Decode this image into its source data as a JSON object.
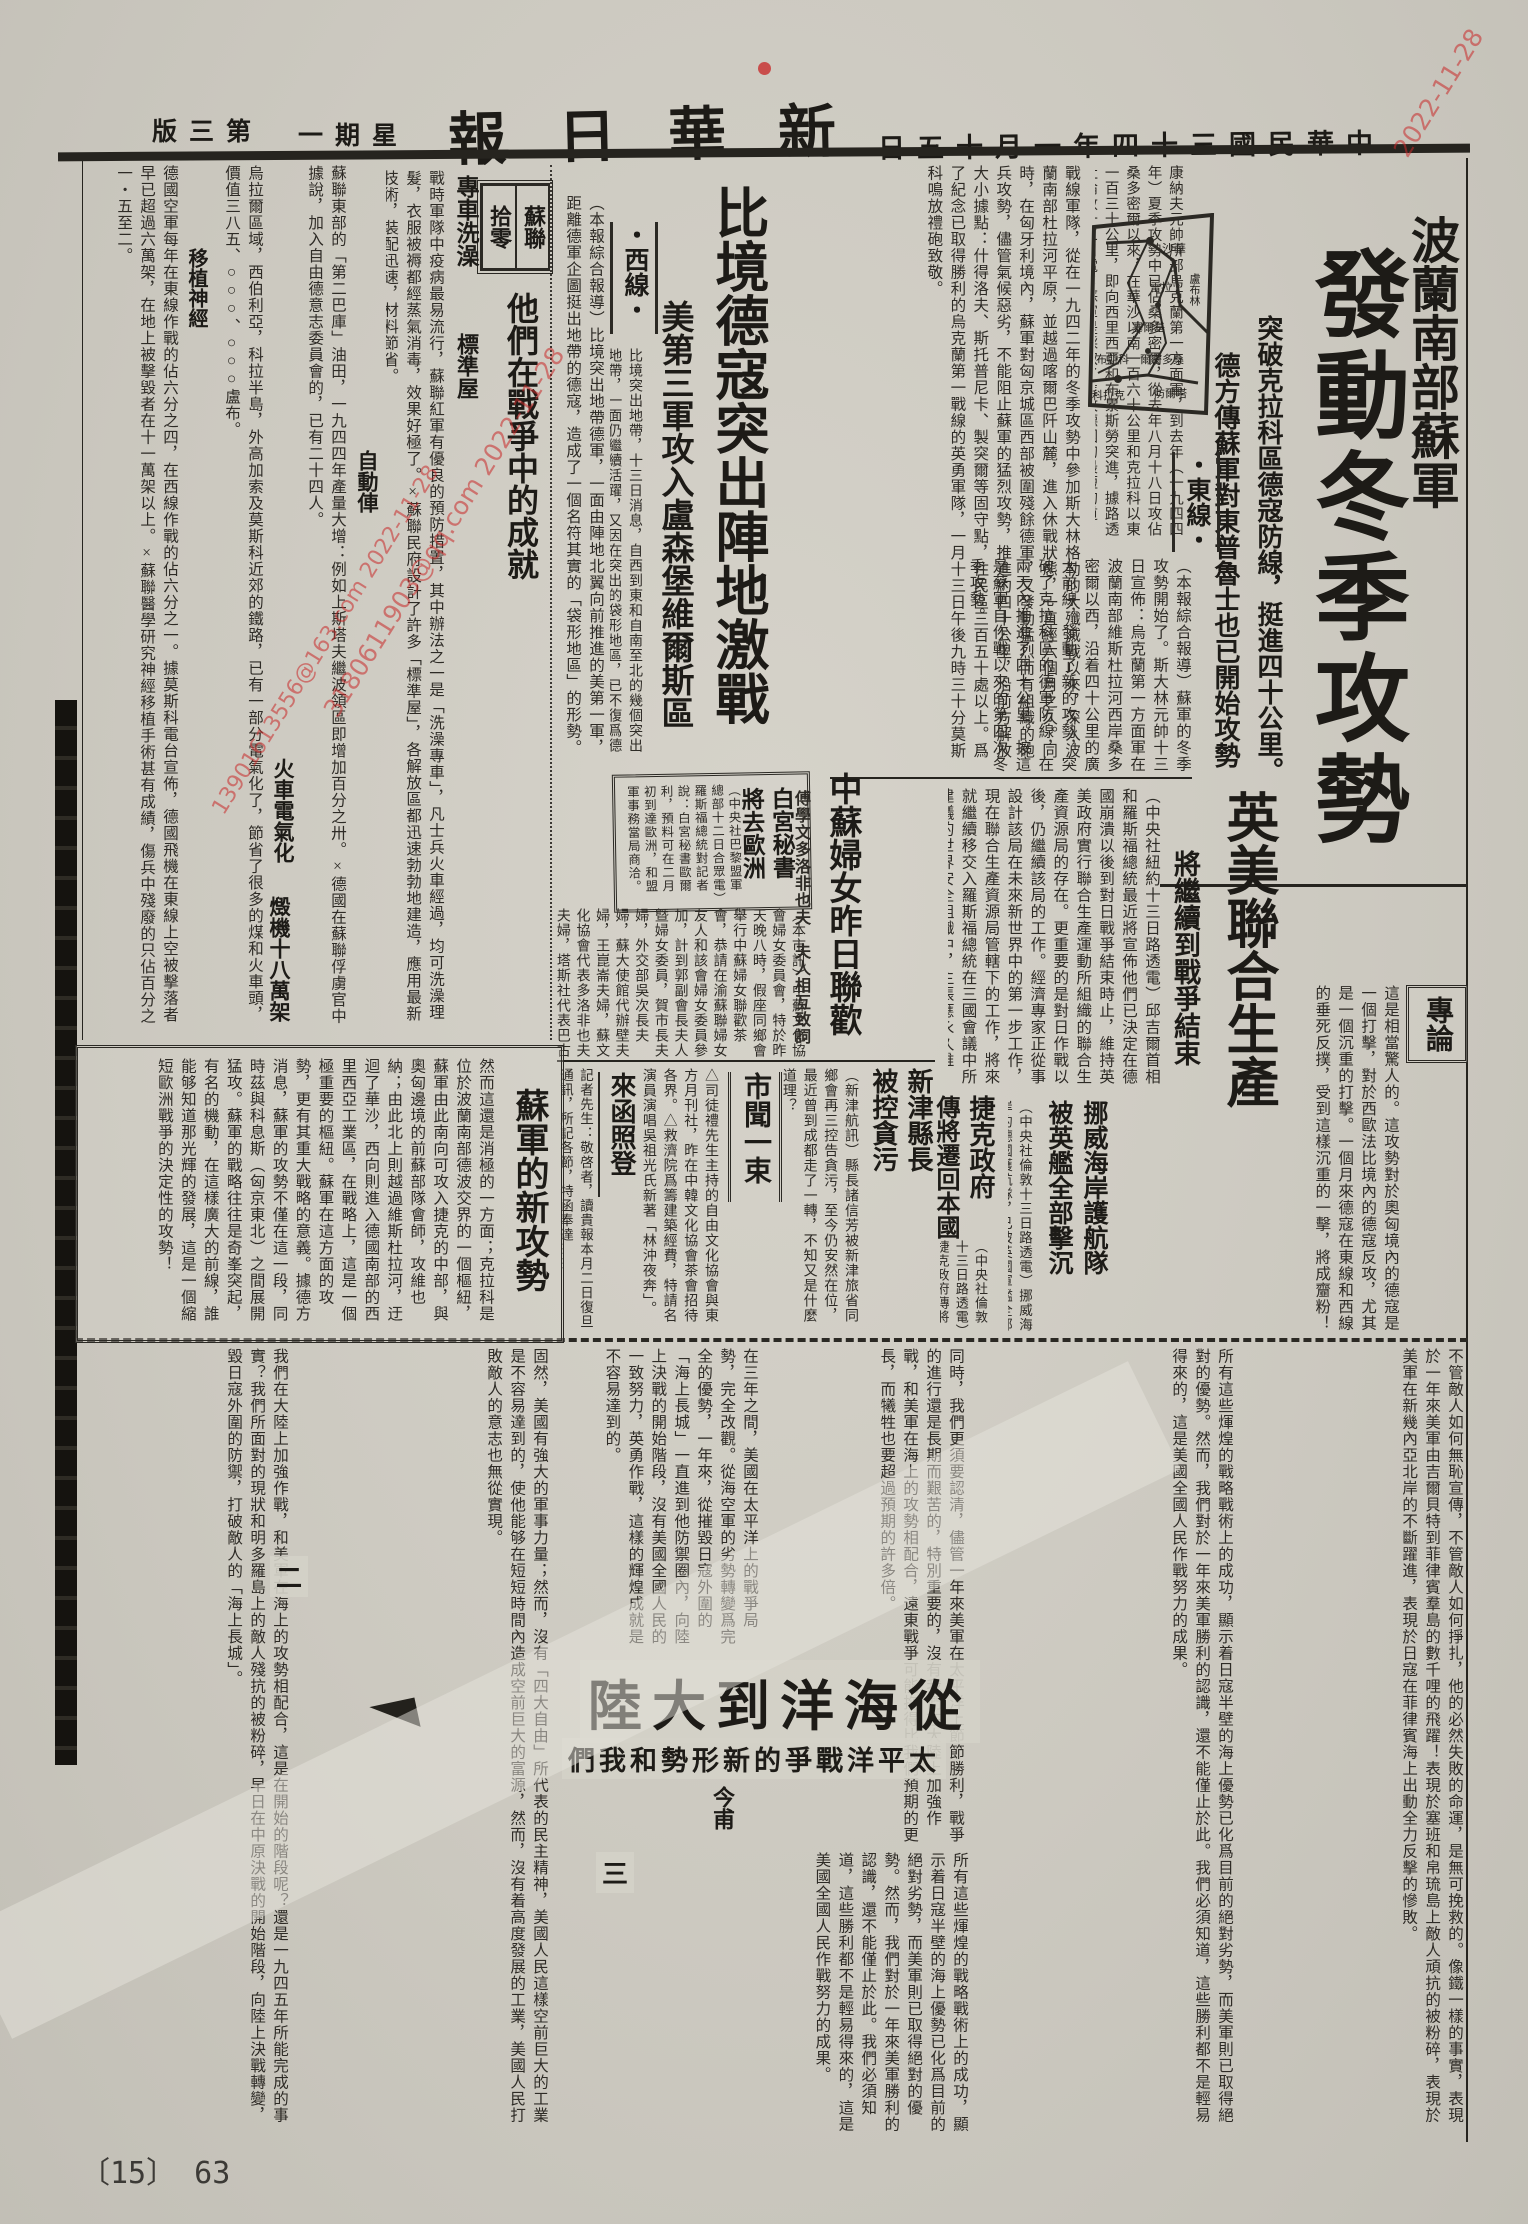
{
  "masthead": {
    "title": "報日華新",
    "date": "日五十月一年四十三國民華中",
    "weekday": "一期星",
    "page_no": "版三第"
  },
  "main_story": {
    "kicker": "波蘭南部蘇軍",
    "headline": "發動冬季攻勢",
    "subhead_a": "突破克拉科區德寇防線，挺進四十公里。",
    "subhead_b": "德方傳蘇軍對東普魯士也已開始攻勢",
    "section": "・東線・",
    "lead": "（本報綜合報導）蘇軍的冬季攻勢開始了。斯大林元帥十三日宣佈：烏克蘭第一方面軍在波蘭南部維斯杜拉河西岸桑多密爾以西，沿着四十公里的廣大前線，發動了新的攻勢，突破了克拉科區的德軍防線，在兩天內推進了四十公里。按這是蘇軍自作戰以來的第四次冬季攻勢。",
    "body_a": "康納夫元帥所部烏克蘭第一方面軍，到去年（一九四四年）夏季攻勢中已佔桑多密爾，從去年八月十八日攻佔桑多密爾以來，在華沙以南一百六十公里和克拉科以東一百三十公里，即向西里西亞和布累斯勞突進，據路透社倫敦十三日電：蘇軍是採取了進攻德國的最短的道路。",
    "body_b": "戰線軍隊，從在一九四二年的冬季攻勢中參加斯大林格勒的大殲滅戰以來，深入波蘭南部杜拉河平原，並越過喀爾巴阡山麓，進入休戰狀態，一直經六個月之久。同時，在匈牙利境內，蘇軍對匈京城區西部被圍殘餘德軍，又發動猛烈而有組織的砲兵攻勢，儘管氣候惡劣，不能阻止蘇軍的猛烈攻勢，推進約四十公里，沿前方解放大小據點：什得洛夫、斯托普尼卡、製突爾等固守點，住民區三百五十處以上。爲了紀念已取得勝利的烏克蘭第一戰線的英勇軍隊，一月十三日午後九時三十分莫斯科鳴放禮砲致敬。"
  },
  "map": {
    "labels": [
      "沙華",
      "盧布林",
      "雷拉",
      "塞爾基",
      "爾密多桑",
      "布斯科",
      "科拉克",
      "防爾塔"
    ]
  },
  "west_story": {
    "section": "・西線・",
    "headline": "比境德寇突出陣地激戰",
    "subhead": "美第三軍攻入盧森堡維爾斯區",
    "lead": "（本報綜合報導）比境突出地帶德軍，一面由陣地北翼向前推進的美第一軍，距離德軍企圖挺出地帶的德寇，造成了一個名符其實的「袋形地區」的形勢。",
    "body": "比境突出地帶，十三日消息，自西到東和自南至北的幾個突出地帶，一面仍繼續活躍，又因在突出的袋形地區，已不復爲德寇所用，經過了一次大轟炸之後，聖維斯公路已不能再被利用，美軍已分由四面逼進。"
  },
  "soviet_notes": {
    "box_label_right": "蘇聯",
    "box_label_left": "拾零",
    "bath_title": "專車洗澡",
    "house_title": "標準屋",
    "car_title": "自動俥",
    "train_title": "火車電氣化",
    "planes_title": "燬機十八萬架",
    "nerve_title": "移植神經",
    "big_headline": "他們在戰爭中的成就",
    "body_a": "戰時軍隊中疫病最易流行，蘇聯紅軍有優良的預防措置，其中辦法之一是「洗澡專車」，凡士兵火車經過，均可洗澡理髮，衣服被褥都經蒸氣消毒，效果好極了。×蘇聯民府設計了許多「標準屋」，各解放區都迅速勃勃地建造，應用最新技術，裝配迅速，材料節省。",
    "body_b": "蘇聯東部的「第二巴庫」油田，一九四四年產量大增：例如上斯塔夫繼波領區即增加百分之卅。×德國在蘇聯俘虜官中據說，加入自由德意志委員會的，已有二十四人。",
    "body_c": "烏拉爾區域，西伯利亞，科拉半島，外高加索及莫斯科近郊的鐵路，已有一部分電氣化了，節省了很多的煤和火車頭，價值三八五、○○○、○○○盧布。",
    "body_d": "德國空軍每年在東線作戰的佔六分之四，在西線作戰的佔六分之一。據莫斯科電台宣佈，德國飛機在東線上空被擊落者早已超過六萬架，在地上被擊毀者在十一萬架以上。×蘇聯醫學研究神經移植手術甚有成績，傷兵中殘廢的只佔百分之一・五至二。"
  },
  "white_house": {
    "headline_a": "白宮秘書",
    "headline_b": "將去歐洲",
    "body": "（中央社巴黎盟軍總部十二日合眾電）羅斯福總統對記者說：白宮秘書歐爾利，預料可在二月初到達歐洲，和盟軍事務當局商洽。"
  },
  "joint_production": {
    "headline": "英美聯合生產",
    "subhead": "將繼續到戰爭結束",
    "body": "（中央社紐約十三日路透電）邱吉爾首相和羅斯福總統最近將宣佈他們已決定在德國崩潰以後到對日戰爭結束時止，維持英美政府實行聯合生產運動所組織的聯合生產資源局的存在。更重要的是對日作戰以後，仍繼續該局的工作。經濟專家正從事設計該局在未來新世界中的第一步工作，現在聯合生產資源局管轄下的工作，將來就繼續移交入羅斯福總統在三國會議中所建議的世界安全組織中，主張應永久維持。"
  },
  "women_meeting": {
    "headline": "中蘇婦女昨日聯歡",
    "subhead_a": "傅學文多洛非也夫",
    "subhead_b": "夫人相互致詞",
    "body": "（本市訊）中蘇文化協會婦女委員會，特於昨天晚八時，假座同鄉會舉行中蘇婦女聯歡茶會，恭請在渝蘇聯婦女友人和該會婦女委員參加，計到郭副會長夫人曁婦女委員，賀市長夫婦，外交部吳次長夫婦，蘇大使館代辦壁夫婦，王崑崙夫婦，蘇文化協會代表多洛非也夫夫婦，塔斯社代表巴古林夫婦等百餘人，孫會長夫婦親臨主持，致開會詞後，中蘇婦女們情意洋溢，至十一時始散。"
  },
  "norway": {
    "headline_a": "挪威海岸護航隊",
    "headline_b": "被英艦全部擊沉",
    "body": "（中央社倫敦十三日路透電）挪威海岸的德國護航隊，已被英國軍艦全部擊沉。"
  },
  "czech": {
    "headline_a": "捷克政府",
    "headline_b": "傳將遷回本國",
    "body": "（中央社倫敦十三日路透電）捷克政府傳將於最近遷回本國。"
  },
  "xinjin": {
    "headline_a": "新津縣長",
    "headline_b": "被控貪污",
    "body": "（新津航訊）縣長諸信芳被新津旅省同鄉會再三控告貪污，至今仍安然在位，最近曾到成都走了一轉，不知又是什麼道理？"
  },
  "city_news": {
    "headline": "市聞一束",
    "items": "△司徒禮先生主持的自由文化協會與東方月刊社，昨在中韓文化協會茶會招待各界。△救濟院爲籌建築經費，特請名演員演唱吳祖光氏新著「林沖夜奔」。"
  },
  "letters": {
    "headline": "來函照登",
    "body": "記者先生：敬啓者，讀貴報本月二日復旦通訊，所記各節，特函奉達……"
  },
  "editorial": {
    "label": "專論",
    "headline": "蘇軍的新攻勢",
    "opening": "這是相當驚人的。這攻勢對於奧匈境內的德寇是一個打擊，對於西歐法比境內的德寇反攻，尤其是一個沉重的打擊。一個月來德寇在東線和西線的垂死反撲，受到這樣沉重的一擊，將成齏粉！",
    "body": "然而這還是消極的一方面；克拉科是位於波蘭南部德波交界的一個樞紐，蘇軍由此南向可攻入捷克的中部，與奧匈邊境的前蘇部隊會師，攻維也納；由此北上則越過維斯杜拉河，迂迴了華沙，西向則進入德國南部的西里西亞工業區，在戰略上，這是一個極重要的樞紐。蘇軍在這方面的攻勢，更有其重大戰略的意義。據德方消息，蘇軍的攻勢不僅在這一段，同時茲與科息斯（匈京東北）之間展開猛攻。蘇軍的戰略往往是奇峯突起，有名的機動，在這樣廣大的前線，誰能够知道那光輝的發展，這是一個縮短歐洲戰爭的決定性的攻勢！"
  },
  "ocean_article": {
    "headline": "陸大到洋海從",
    "subhead": "們我和勢形新的爭戰洋平太",
    "author": "今甫",
    "marker_two": "二",
    "marker_three": "三",
    "body_a": "不管敵人如何無恥宣傳，不管敵人如何掙扎，他的必然失敗的命運，是無可挽救的。像鐵一樣的事實，表現於一年來美軍由吉爾貝特到菲律賓羣島的數千哩的飛躍！表現於塞班和帛琉島上敵人頑抗的被粉碎，表現於美軍在新幾內亞北岸的不斷躍進，表現於日寇在菲律賓海上出動全力反擊的慘敗。",
    "body_b": "所有這些煇煌的戰略戰術上的成功，顯示着日寇半壁的海上優勢已化爲目前的絕對劣勢，而美軍則已取得絕對的優勢。然而，我們對於一年來美軍勝利的認識，還不能僅止於此。我們必須知道，這些勝利都不是輕易得來的，這是美國全國人民作戰努力的成果。",
    "body_c": "同時，我們更須要認清，儘管一年來美軍在太平洋上節節勝利，戰爭的進行還是長期而艱苦的，特別重要的，沒有我們在大陸上加強作戰，和美軍在海上的攻勢相配合，遠東戰爭可能拖得比我們預期的更長，而犧牲也要超過預期的許多倍。",
    "body_d": "在三年之間，美國在太平洋上的戰爭局勢，完全改觀。從海空軍的劣勢轉變爲完全的優勢，一年來，從摧毀日寇外圍的「海上長城」一直進到他防禦圈內，向陸上決戰的開始階段，沒有美國全國人民的一致努力，英勇作戰，這樣的輝煌成就是不容易達到的。",
    "body_e": "固然，美國有強大的軍事力量；然而，沒有「四大自由」所代表的民主精神，美國人民這樣空前巨大的工業是不容易達到的，使他能够在短短時間內造成空前巨大的富源，然而，沒有着高度發展的工業，美國人民打敗敵人的意志也無從實現。",
    "body_f": "我們在大陸上加強作戰，和美軍在海上的攻勢相配合，這是在開始的階段呢？還是一九四五年所能完成的事實？我們所面對的現狀和明多羅島上的敵人殘抗的被粉碎，早日在中原決戰的開始階段，向陸上決戰轉變，毀日寇外圍的防禦，打破敵人的「海上長城」。"
  },
  "footer": {
    "page_label": "〔15〕 63"
  },
  "watermarks": {
    "a": "3180611903@qq.com 2022-11-28",
    "b": "13901613556@163.com 2022-11-28",
    "c": "2022-11-28"
  }
}
